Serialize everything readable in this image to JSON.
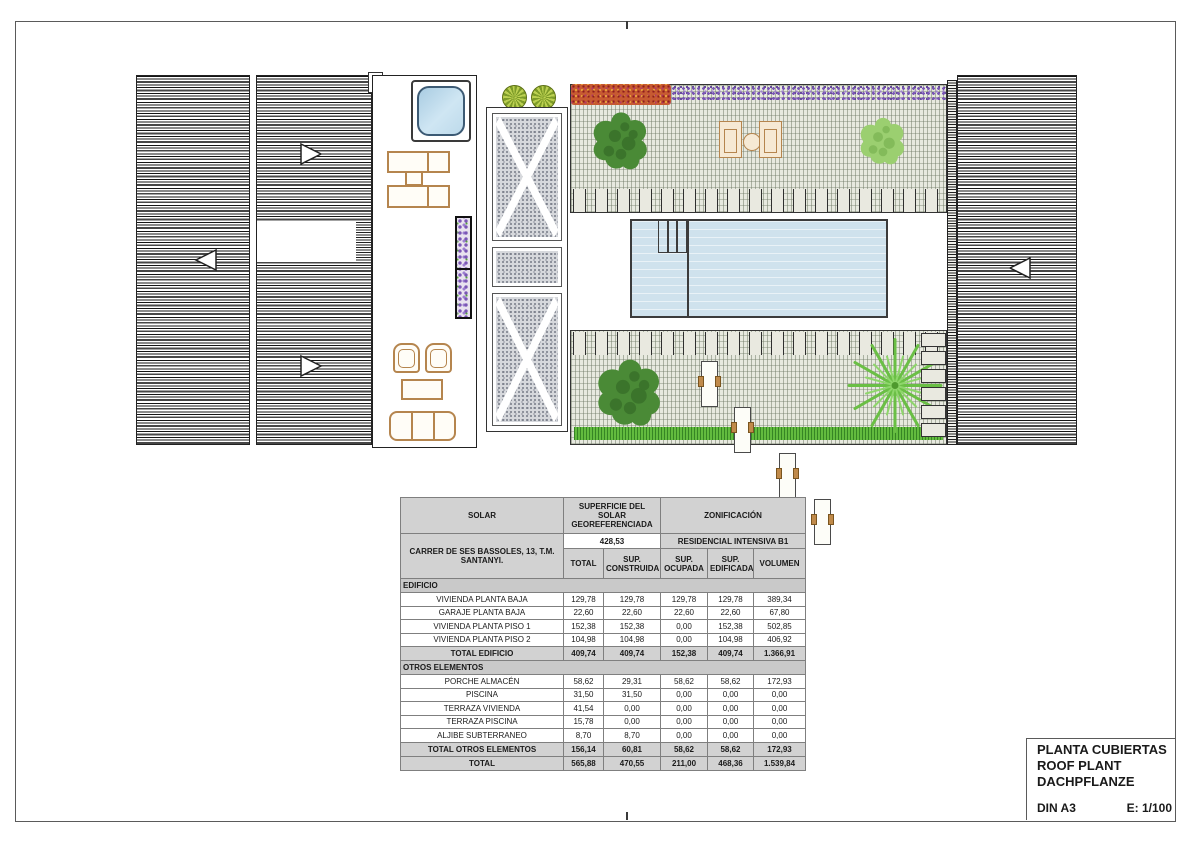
{
  "title_block": {
    "line1": "PLANTA CUBIERTAS",
    "line2": "ROOF PLANT",
    "line3": "DACHPFLANZE",
    "format": "DIN A3",
    "scale": "E: 1/100"
  },
  "table": {
    "header": {
      "solar": "SOLAR",
      "superficie": "SUPERFICIE DEL SOLAR GEOREFERENCIADA",
      "zonificacion": "ZONIFICACIÓN",
      "address": "CARRER DE SES BASSOLES, 13, T.M. SANTANYI.",
      "superficie_value": "428,53",
      "zona_value": "RESIDENCIAL INTENSIVA B1",
      "columns": [
        "TOTAL",
        "SUP. CONSTRUIDA",
        "SUP. OCUPADA",
        "SUP. EDIFICADA",
        "VOLUMEN"
      ]
    },
    "sections": [
      {
        "name": "EDIFICIO",
        "rows": [
          {
            "label": "VIVIENDA PLANTA BAJA",
            "values": [
              "129,78",
              "129,78",
              "129,78",
              "129,78",
              "389,34"
            ]
          },
          {
            "label": "GARAJE PLANTA BAJA",
            "values": [
              "22,60",
              "22,60",
              "22,60",
              "22,60",
              "67,80"
            ]
          },
          {
            "label": "VIVIENDA PLANTA PISO 1",
            "values": [
              "152,38",
              "152,38",
              "0,00",
              "152,38",
              "502,85"
            ]
          },
          {
            "label": "VIVIENDA PLANTA PISO 2",
            "values": [
              "104,98",
              "104,98",
              "0,00",
              "104,98",
              "406,92"
            ]
          }
        ],
        "total": {
          "label": "TOTAL EDIFICIO",
          "values": [
            "409,74",
            "409,74",
            "152,38",
            "409,74",
            "1.366,91"
          ]
        }
      },
      {
        "name": "OTROS ELEMENTOS",
        "rows": [
          {
            "label": "PORCHE ALMACÉN",
            "values": [
              "58,62",
              "29,31",
              "58,62",
              "58,62",
              "172,93"
            ]
          },
          {
            "label": "PISCINA",
            "values": [
              "31,50",
              "31,50",
              "0,00",
              "0,00",
              "0,00"
            ]
          },
          {
            "label": "TERRAZA VIVIENDA",
            "values": [
              "41,54",
              "0,00",
              "0,00",
              "0,00",
              "0,00"
            ]
          },
          {
            "label": "TERRAZA PISCINA",
            "values": [
              "15,78",
              "0,00",
              "0,00",
              "0,00",
              "0,00"
            ]
          },
          {
            "label": "ALJIBE SUBTERRANEO",
            "values": [
              "8,70",
              "8,70",
              "0,00",
              "0,00",
              "0,00"
            ]
          }
        ],
        "total": {
          "label": "TOTAL OTROS ELEMENTOS",
          "values": [
            "156,14",
            "60,81",
            "58,62",
            "58,62",
            "172,93"
          ]
        }
      }
    ],
    "grand_total": {
      "label": "TOTAL",
      "values": [
        "565,88",
        "470,55",
        "211,00",
        "468,36",
        "1.539,84"
      ]
    }
  },
  "colors": {
    "pool_blue": "#cfe2ed",
    "jacuzzi_blue": "#bcd8ea",
    "grass_green": "#62bb3e",
    "pergola_grid": "#e7e9df",
    "gravel_gray": "#d6d8dc",
    "furniture_tan": "#b5854e",
    "table_header_gray": "#d2d2d2"
  }
}
